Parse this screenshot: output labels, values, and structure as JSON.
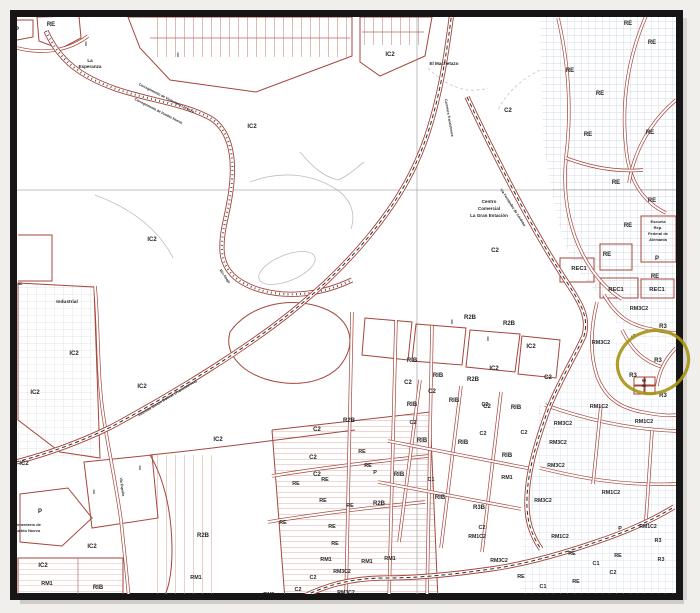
{
  "page": {
    "background": "#f1efec"
  },
  "frame": {
    "stroke": "#161616"
  },
  "palette": {
    "parcel_red": "#a6453c",
    "grid_blue": "#c3cedd",
    "road_dash": "#2e2e2e",
    "gray_line": "#bdbdbd",
    "label": "#262626"
  },
  "highlight": {
    "color": "#a59413",
    "cx": 653,
    "cy": 362,
    "rx": 36,
    "ry": 31,
    "rotate": -18,
    "stroke_width": 3.2
  },
  "map": {
    "labels": [
      {
        "t": "P",
        "x": 17,
        "y": 31,
        "s": 6
      },
      {
        "t": "RE",
        "x": 51,
        "y": 26
      },
      {
        "t": "I",
        "x": 86,
        "y": 46
      },
      {
        "t": "La",
        "x": 90,
        "y": 62,
        "s": 4.6
      },
      {
        "t": "Esperanza",
        "x": 90,
        "y": 68,
        "s": 4.6
      },
      {
        "t": "I",
        "x": 178,
        "y": 57
      },
      {
        "t": "IC2",
        "x": 252,
        "y": 128
      },
      {
        "t": "IC2",
        "x": 152,
        "y": 241
      },
      {
        "t": "IC2",
        "x": 390,
        "y": 56
      },
      {
        "t": "El Machetazo",
        "x": 444,
        "y": 65,
        "s": 4.6
      },
      {
        "t": "C2",
        "x": 508,
        "y": 112
      },
      {
        "t": "Centro",
        "x": 489,
        "y": 203,
        "s": 4.6
      },
      {
        "t": "Comercial",
        "x": 489,
        "y": 210,
        "s": 4.6
      },
      {
        "t": "La Gran Estación",
        "x": 489,
        "y": 217,
        "s": 4.6
      },
      {
        "t": "C2",
        "x": 495,
        "y": 252
      },
      {
        "t": "Corregimiento de Victoriano Lorenzo",
        "x": 166,
        "y": 99,
        "s": 3.5,
        "r": 27
      },
      {
        "t": "Corregimiento de Pueblo Nuevo",
        "x": 158,
        "y": 112,
        "s": 3.5,
        "r": 27
      },
      {
        "t": "Río Abajo",
        "x": 224,
        "y": 277,
        "s": 3.5,
        "r": 55
      },
      {
        "t": "RE",
        "x": 628,
        "y": 25
      },
      {
        "t": "RE",
        "x": 652,
        "y": 44
      },
      {
        "t": "RE",
        "x": 570,
        "y": 72
      },
      {
        "t": "RE",
        "x": 600,
        "y": 95
      },
      {
        "t": "RE",
        "x": 588,
        "y": 136
      },
      {
        "t": "RE",
        "x": 650,
        "y": 134
      },
      {
        "t": "RE",
        "x": 616,
        "y": 184
      },
      {
        "t": "RE",
        "x": 652,
        "y": 202
      },
      {
        "t": "RE",
        "x": 628,
        "y": 227
      },
      {
        "t": "RE",
        "x": 607,
        "y": 256
      },
      {
        "t": "Escuela",
        "x": 658,
        "y": 223,
        "s": 4
      },
      {
        "t": "Rep.",
        "x": 658,
        "y": 229,
        "s": 4
      },
      {
        "t": "Federal de",
        "x": 658,
        "y": 235,
        "s": 4
      },
      {
        "t": "Alemania",
        "x": 658,
        "y": 241,
        "s": 4
      },
      {
        "t": "P",
        "x": 657,
        "y": 260
      },
      {
        "t": "REC1",
        "x": 579,
        "y": 270,
        "s": 5.8
      },
      {
        "t": "RE",
        "x": 655,
        "y": 278
      },
      {
        "t": "REC1",
        "x": 616,
        "y": 291,
        "s": 5.8
      },
      {
        "t": "REC1",
        "x": 657,
        "y": 291,
        "s": 5.8
      },
      {
        "t": "RM3C2",
        "x": 639,
        "y": 310,
        "s": 5.4
      },
      {
        "t": "R3",
        "x": 663,
        "y": 328
      },
      {
        "t": "RM3C2",
        "x": 601,
        "y": 344,
        "s": 5.4
      },
      {
        "t": "C2",
        "x": 634,
        "y": 337,
        "s": 3.8,
        "r": -40
      },
      {
        "t": "R3",
        "x": 658,
        "y": 362
      },
      {
        "t": "R3",
        "x": 633,
        "y": 377
      },
      {
        "t": "RE",
        "x": 644,
        "y": 382,
        "s": 3.2
      },
      {
        "t": "RE",
        "x": 644,
        "y": 387,
        "s": 3.2
      },
      {
        "t": "R3",
        "x": 663,
        "y": 397
      },
      {
        "t": "RM1C2",
        "x": 599,
        "y": 408,
        "s": 5.4
      },
      {
        "t": "RM1C2",
        "x": 644,
        "y": 423,
        "s": 5.4
      },
      {
        "t": "ac",
        "x": 20,
        "y": 285,
        "s": 4.4
      },
      {
        "t": "Industrial",
        "x": 67,
        "y": 303,
        "s": 4.8
      },
      {
        "t": "IC2",
        "x": 74,
        "y": 355
      },
      {
        "t": "IC2",
        "x": 35,
        "y": 394
      },
      {
        "t": "IC2",
        "x": 142,
        "y": 388
      },
      {
        "t": "IC2",
        "x": 218,
        "y": 441
      },
      {
        "t": "Avenida Simón Bolívar (Transístmica)",
        "x": 168,
        "y": 399,
        "s": 3.8,
        "r": -31
      },
      {
        "t": "Carretera Transístmica",
        "x": 448,
        "y": 118,
        "s": 3.5,
        "r": 80
      },
      {
        "t": "Vía Fernández de Córdoba",
        "x": 512,
        "y": 208,
        "s": 3.5,
        "r": 57
      },
      {
        "t": "Vía España",
        "x": 121,
        "y": 487,
        "s": 3.5,
        "r": 82
      },
      {
        "t": "R2B",
        "x": 470,
        "y": 319
      },
      {
        "t": "I",
        "x": 452,
        "y": 324
      },
      {
        "t": "R2B",
        "x": 509,
        "y": 325
      },
      {
        "t": "I",
        "x": 488,
        "y": 341
      },
      {
        "t": "IC2",
        "x": 531,
        "y": 348
      },
      {
        "t": "C2",
        "x": 548,
        "y": 379
      },
      {
        "t": "IC2",
        "x": 494,
        "y": 370
      },
      {
        "t": "R2B",
        "x": 473,
        "y": 381
      },
      {
        "t": "RIB",
        "x": 412,
        "y": 362
      },
      {
        "t": "RIB",
        "x": 438,
        "y": 377
      },
      {
        "t": "C2",
        "x": 408,
        "y": 384
      },
      {
        "t": "C2",
        "x": 432,
        "y": 393
      },
      {
        "t": "RIB",
        "x": 454,
        "y": 402
      },
      {
        "t": "C2",
        "x": 487,
        "y": 408
      },
      {
        "t": "RIB",
        "x": 516,
        "y": 409
      },
      {
        "t": "RM3C2",
        "x": 563,
        "y": 425,
        "s": 5.4
      },
      {
        "t": "R2B",
        "x": 349,
        "y": 422
      },
      {
        "t": "C2",
        "x": 317,
        "y": 431
      },
      {
        "t": "C2",
        "x": 313,
        "y": 459
      },
      {
        "t": "C2",
        "x": 317,
        "y": 476
      },
      {
        "t": "RE",
        "x": 362,
        "y": 453,
        "s": 5.4
      },
      {
        "t": "RE",
        "x": 368,
        "y": 467,
        "s": 5.4
      },
      {
        "t": "P",
        "x": 375,
        "y": 474,
        "s": 5.4
      },
      {
        "t": "RE",
        "x": 325,
        "y": 481,
        "s": 5.4
      },
      {
        "t": "RE",
        "x": 296,
        "y": 485,
        "s": 5.4
      },
      {
        "t": "RE",
        "x": 323,
        "y": 502,
        "s": 5.4
      },
      {
        "t": "RE",
        "x": 350,
        "y": 507,
        "s": 5.4
      },
      {
        "t": "R2B",
        "x": 379,
        "y": 505
      },
      {
        "t": "RIB",
        "x": 399,
        "y": 476
      },
      {
        "t": "RE",
        "x": 283,
        "y": 524,
        "s": 5.4
      },
      {
        "t": "RE",
        "x": 332,
        "y": 528,
        "s": 5.4
      },
      {
        "t": "RE",
        "x": 335,
        "y": 545,
        "s": 5.4
      },
      {
        "t": "RM1",
        "x": 326,
        "y": 561,
        "s": 5.4
      },
      {
        "t": "RM1",
        "x": 367,
        "y": 563,
        "s": 5.4
      },
      {
        "t": "RM1",
        "x": 390,
        "y": 560,
        "s": 5.4
      },
      {
        "t": "RM3C2",
        "x": 342,
        "y": 573,
        "s": 5.2
      },
      {
        "t": "C2",
        "x": 313,
        "y": 579,
        "s": 5.4
      },
      {
        "t": "C2",
        "x": 298,
        "y": 591,
        "s": 5.4
      },
      {
        "t": "RM1",
        "x": 269,
        "y": 596,
        "s": 5.4
      },
      {
        "t": "RM3C2",
        "x": 346,
        "y": 594,
        "s": 5.2
      },
      {
        "t": "RM3C2",
        "x": 392,
        "y": 598,
        "s": 5.2
      },
      {
        "t": "RIB",
        "x": 412,
        "y": 406
      },
      {
        "t": "C2",
        "x": 413,
        "y": 424,
        "s": 5.4
      },
      {
        "t": "RIB",
        "x": 422,
        "y": 442
      },
      {
        "t": "RIB",
        "x": 463,
        "y": 444
      },
      {
        "t": "C2",
        "x": 483,
        "y": 435,
        "s": 5.4
      },
      {
        "t": "C1",
        "x": 431,
        "y": 481,
        "s": 5.4
      },
      {
        "t": "RIB",
        "x": 440,
        "y": 499
      },
      {
        "t": "C2",
        "x": 485,
        "y": 406,
        "s": 5.4
      },
      {
        "t": "R3B",
        "x": 479,
        "y": 509
      },
      {
        "t": "C2",
        "x": 482,
        "y": 529,
        "s": 5.4
      },
      {
        "t": "RM1C2",
        "x": 477,
        "y": 538,
        "s": 5.2
      },
      {
        "t": "RM1",
        "x": 507,
        "y": 479,
        "s": 5.4
      },
      {
        "t": "C2",
        "x": 524,
        "y": 434,
        "s": 5.4
      },
      {
        "t": "RIB",
        "x": 507,
        "y": 457
      },
      {
        "t": "RM3C2",
        "x": 558,
        "y": 444,
        "s": 5.2
      },
      {
        "t": "RM3C2",
        "x": 556,
        "y": 467,
        "s": 5.2
      },
      {
        "t": "RM3C2",
        "x": 543,
        "y": 502,
        "s": 5.2
      },
      {
        "t": "RM1C2",
        "x": 611,
        "y": 494,
        "s": 5.4
      },
      {
        "t": "RM1C2",
        "x": 560,
        "y": 538,
        "s": 5.2
      },
      {
        "t": "RM3C2",
        "x": 499,
        "y": 562,
        "s": 5.2
      },
      {
        "t": "P",
        "x": 620,
        "y": 530,
        "s": 5.4
      },
      {
        "t": "RM1C2",
        "x": 648,
        "y": 528,
        "s": 5.2
      },
      {
        "t": "R3",
        "x": 658,
        "y": 542,
        "s": 5.4
      },
      {
        "t": "R3",
        "x": 661,
        "y": 561,
        "s": 5.4
      },
      {
        "t": "RE",
        "x": 618,
        "y": 557,
        "s": 5.4
      },
      {
        "t": "C1",
        "x": 596,
        "y": 565,
        "s": 5.4
      },
      {
        "t": "C2",
        "x": 613,
        "y": 574,
        "s": 5.4
      },
      {
        "t": "RE",
        "x": 576,
        "y": 583,
        "s": 5.4
      },
      {
        "t": "RE",
        "x": 572,
        "y": 555,
        "s": 5.4
      },
      {
        "t": "C1",
        "x": 543,
        "y": 588,
        "s": 5.4
      },
      {
        "t": "RE",
        "x": 521,
        "y": 578,
        "s": 5.4
      },
      {
        "t": "IC2",
        "x": 24,
        "y": 465
      },
      {
        "t": "I",
        "x": 94,
        "y": 494
      },
      {
        "t": "I",
        "x": 140,
        "y": 470
      },
      {
        "t": "P",
        "x": 40,
        "y": 513
      },
      {
        "t": "Cementerio de",
        "x": 27,
        "y": 526,
        "s": 4
      },
      {
        "t": "Pueblo Nuevo",
        "x": 27,
        "y": 532,
        "s": 4
      },
      {
        "t": "IC2",
        "x": 92,
        "y": 548
      },
      {
        "t": "IC2",
        "x": 43,
        "y": 567
      },
      {
        "t": "RM1",
        "x": 47,
        "y": 585,
        "s": 5.4
      },
      {
        "t": "RIB",
        "x": 98,
        "y": 589
      },
      {
        "t": "I",
        "x": 15,
        "y": 585,
        "s": 5.4
      },
      {
        "t": "R2B",
        "x": 203,
        "y": 537
      },
      {
        "t": "RM1",
        "x": 196,
        "y": 579,
        "s": 5.4
      }
    ]
  }
}
